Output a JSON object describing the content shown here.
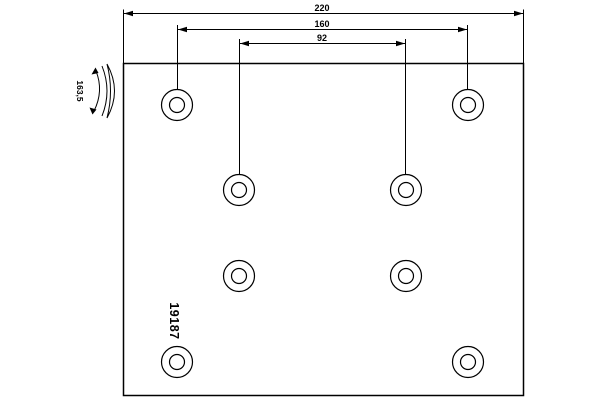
{
  "drawing": {
    "part_number": "19187",
    "dimensions": {
      "overall_width": "220",
      "outer_hole_spacing": "160",
      "inner_hole_spacing": "92",
      "radius": "163,5"
    },
    "hole_count": 8,
    "colors": {
      "line": "#000000",
      "background": "#ffffff"
    }
  }
}
